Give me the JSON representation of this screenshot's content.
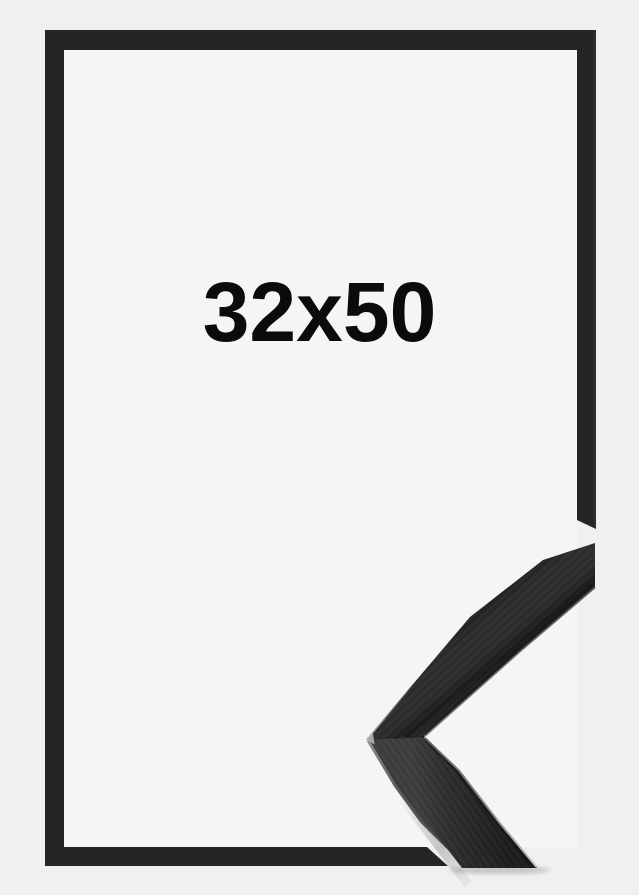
{
  "product": {
    "size_label": "32x50"
  },
  "colors": {
    "page-bg": "#f0f0f1",
    "frame-black": "#242527",
    "opening-white": "#f5f5f6",
    "label-text": "#0b0b0c"
  }
}
